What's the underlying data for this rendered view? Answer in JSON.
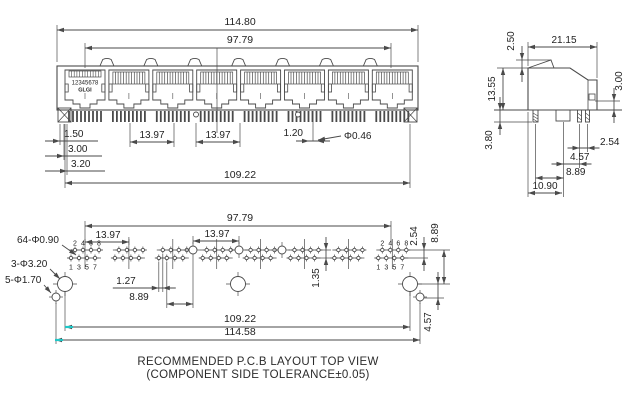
{
  "drawing": {
    "caption_line1": "RECOMMENDED P.C.B LAYOUT TOP VIEW",
    "caption_line2": "(COMPONENT SIDE TOLERANCE±0.05)",
    "colors": {
      "line": "#4a4a4a",
      "text": "#232323",
      "accent_teal": "#1fc7c7"
    },
    "front_view": {
      "port_count": 8,
      "bump_count": 7,
      "port1_digits": "12345678",
      "port1_brand": "GLGI",
      "dims": [
        {
          "t": "h",
          "l": "114.80",
          "x1": 57,
          "x2": 418,
          "y": 30,
          "a": "in",
          "tx": 240,
          "ty": 25,
          "s": 10.5
        },
        {
          "t": "h",
          "l": "97.79",
          "x1": 85,
          "x2": 391,
          "y": 48,
          "a": "in",
          "tx": 240,
          "ty": 43,
          "s": 10.5
        },
        {
          "t": "h",
          "l": "13.97",
          "x1": 130,
          "x2": 174,
          "y": 142,
          "a": "in",
          "tx": 152,
          "ty": 138
        },
        {
          "t": "h",
          "l": "13.97",
          "x1": 196,
          "x2": 240,
          "y": 142,
          "a": "in",
          "tx": 218,
          "ty": 138
        },
        {
          "t": "h",
          "l": "109.22",
          "x1": 65,
          "x2": 410,
          "y": 183,
          "a": "in",
          "tx": 240,
          "ty": 178,
          "s": 10.5
        },
        {
          "t": "shelf",
          "l": "1.50",
          "y": 141,
          "tail": 45,
          "tip": 60,
          "end": 98,
          "tx": 64,
          "ty": 137
        },
        {
          "t": "shelf",
          "l": "3.00",
          "y": 156,
          "tail": 45,
          "tip": 64,
          "end": 102,
          "tx": 68,
          "ty": 152
        },
        {
          "t": "shelf",
          "l": "3.20",
          "y": 171,
          "tail": 45,
          "tip": 67,
          "end": 105,
          "tx": 71,
          "ty": 167
        },
        {
          "t": "h",
          "l": "1.20",
          "x1": 309,
          "x2": 317,
          "y": 141,
          "a": "out",
          "tails": 13,
          "tx": 303,
          "ty": 136,
          "anc": "end"
        },
        {
          "t": "lead",
          "l": "Φ0.46",
          "x1": 341,
          "y1": 136,
          "x2": 318,
          "y2": 140,
          "tx": 344,
          "ty": 139,
          "anc": "start"
        }
      ]
    },
    "side_view": {
      "dims": [
        {
          "t": "v",
          "l": "2.50",
          "x": 522,
          "y1": 60,
          "y2": 68,
          "a": "out",
          "tails": 14,
          "tx": 514,
          "ty": 41
        },
        {
          "t": "h",
          "l": "21.15",
          "x1": 528,
          "x2": 597,
          "y": 47,
          "a": "in",
          "tx": 564,
          "ty": 43
        },
        {
          "t": "v",
          "l": "13.55",
          "x": 503,
          "y1": 68,
          "y2": 110,
          "a": "in",
          "tx": 495,
          "ty": 89
        },
        {
          "t": "v",
          "l": "3.00",
          "x": 614,
          "y1": 101,
          "y2": 110,
          "a": "out",
          "tails": 13,
          "tx": 622,
          "ty": 81
        },
        {
          "t": "v",
          "l": "3.80",
          "x": 500,
          "y1": 110,
          "y2": 122,
          "a": "out",
          "tails": 13,
          "tx": 492,
          "ty": 140
        },
        {
          "t": "h",
          "l": "2.54",
          "x1": 579.5,
          "x2": 587.5,
          "y": 148,
          "a": "out",
          "tails": 12,
          "tx": 600,
          "ty": 145,
          "anc": "start"
        },
        {
          "t": "h",
          "l": "4.57",
          "x1": 563.5,
          "x2": 579.5,
          "y": 164,
          "a": "out",
          "tails": 12,
          "tx": 570,
          "ty": 160,
          "anc": "start"
        },
        {
          "t": "h",
          "l": "8.89",
          "x1": 535.5,
          "x2": 563.5,
          "y": 178,
          "a": "in",
          "tx": 566,
          "ty": 175,
          "anc": "start"
        },
        {
          "t": "h",
          "l": "10.90",
          "x1": 528,
          "x2": 562,
          "y": 193,
          "a": "in",
          "tx": 545,
          "ty": 189
        }
      ]
    },
    "pcb_view": {
      "group_count": 8,
      "pin_numbers_top": [
        "2",
        "4",
        "6",
        "8"
      ],
      "pin_numbers_bottom": [
        "1",
        "3",
        "5",
        "7"
      ],
      "leaders": [
        {
          "t": "lead",
          "l": "64-Φ0.90",
          "x1": 62,
          "y1": 245,
          "x2": 76,
          "y2": 255,
          "tx": 17,
          "ty": 243,
          "anc": "start"
        },
        {
          "t": "lead",
          "l": "3-Φ3.20",
          "x1": 50,
          "y1": 269,
          "x2": 60,
          "y2": 279,
          "tx": 11,
          "ty": 267,
          "anc": "start"
        },
        {
          "t": "lead",
          "l": "5-Φ1.70",
          "x1": 44,
          "y1": 285,
          "x2": 51,
          "y2": 293,
          "tx": 5,
          "ty": 283,
          "anc": "start"
        }
      ],
      "dims": [
        {
          "t": "h",
          "l": "97.79",
          "x1": 85,
          "x2": 391,
          "y": 226,
          "a": "in",
          "tx": 240,
          "ty": 221,
          "s": 10.5
        },
        {
          "t": "h",
          "l": "13.97",
          "x1": 85,
          "x2": 129,
          "y": 242,
          "a": "in",
          "tx": 108,
          "ty": 238
        },
        {
          "t": "h",
          "l": "13.97",
          "x1": 193,
          "x2": 239,
          "y": 241,
          "a": "in",
          "tx": 217,
          "ty": 237
        },
        {
          "t": "h",
          "l": "1.27",
          "x1": 158.8,
          "x2": 162.8,
          "y": 288,
          "a": "out",
          "tails": 13,
          "tailL": 46,
          "tx": 126,
          "ty": 284
        },
        {
          "t": "h",
          "l": "8.89",
          "x1": 166.8,
          "x2": 193,
          "y": 304,
          "a": "in",
          "tx": 139,
          "ty": 300
        },
        {
          "t": "h",
          "l": "109.22",
          "x1": 65,
          "x2": 410,
          "y": 327,
          "a": "in",
          "tx": 240,
          "ty": 322,
          "s": 10.5
        },
        {
          "t": "h",
          "l": "114.58",
          "x1": 55,
          "x2": 420,
          "y": 340,
          "a": "in",
          "tx": 240,
          "ty": 335,
          "s": 10.5
        },
        {
          "t": "v",
          "l": "2.54",
          "x": 424,
          "y1": 250,
          "y2": 258,
          "a": "out",
          "tails": 13,
          "tx": 417,
          "ty": 236
        },
        {
          "t": "v",
          "l": "8.89",
          "x": 444,
          "y1": 250,
          "y2": 284,
          "a": "in",
          "tx": 438,
          "ty": 233
        },
        {
          "t": "v",
          "l": "1.35",
          "x": 326,
          "y1": 250,
          "y2": 258,
          "a": "out",
          "tails": 13,
          "tx": 319,
          "ty": 278
        },
        {
          "t": "v",
          "l": "4.57",
          "x": 438,
          "y1": 284,
          "y2": 298,
          "a": "out",
          "tails": 12,
          "tx": 431,
          "ty": 322
        }
      ]
    }
  }
}
